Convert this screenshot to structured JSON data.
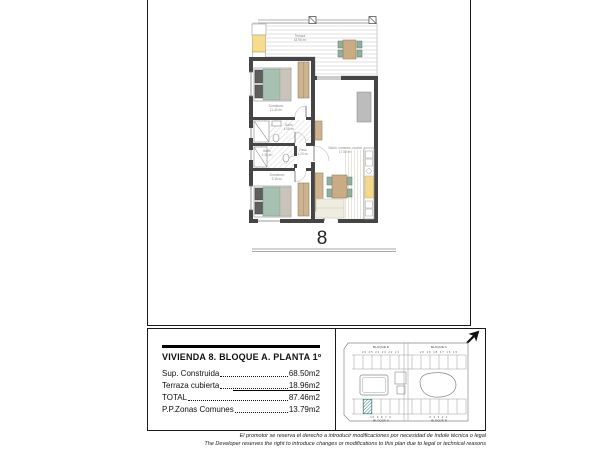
{
  "page": {
    "unit_number": "8"
  },
  "title_block": {
    "title": "VIVIENDA 8. BLOQUE A. PLANTA 1º",
    "rows": [
      {
        "label": "Sup. Construida",
        "value": "68.50m2"
      },
      {
        "label": "Terraza cubierta",
        "value": "18.96m2"
      },
      {
        "label": "TOTAL",
        "value": "87.46m2"
      },
      {
        "label": "P.P.Zonas Comunes",
        "value": "13.79m2"
      }
    ]
  },
  "floor_plan": {
    "rooms": [
      {
        "name": "Terraza",
        "area": "18.96 m²"
      },
      {
        "name": "Dormitorio",
        "area": "11.40 m²"
      },
      {
        "name": "Baño",
        "area": "4.05 m²"
      },
      {
        "name": "Baño",
        "area": "2.30 m²"
      },
      {
        "name": "Paso",
        "area": "1.20 m²"
      },
      {
        "name": "Dormitorio",
        "area": "9.15 m²"
      },
      {
        "name": "Salón, comedor, cocina",
        "area": "17.50 m²"
      }
    ]
  },
  "site_plan": {
    "labels": {
      "top_left": "BLOQUE D",
      "top_right": "BLOQUE C",
      "bottom_left": "BLOQUE A",
      "bottom_right": "BLOQUE B"
    },
    "numbers": {
      "top_left": "26 25 24 23 22 21",
      "top_right": "20 19 18 17 16 15",
      "bottom_left": "10 9 8 7 6",
      "bottom_right": "5 4 3 2 1"
    },
    "highlight_color": "#2e7f7f"
  },
  "disclaimer": {
    "line1": "El promotor se reserva el derecho a introducir modificaciones por necesidad de índole técnica o legal",
    "line2": "The Developer reserves the right to introduce changes or modifications to this plan due to legal or technical reasons"
  },
  "colors": {
    "wall": "#454545",
    "bed_teal": "#a6c0b1",
    "wood_tan": "#cdb48f",
    "kitchen_yellow": "#f3d98b",
    "deck_line": "#d9d9d9"
  }
}
